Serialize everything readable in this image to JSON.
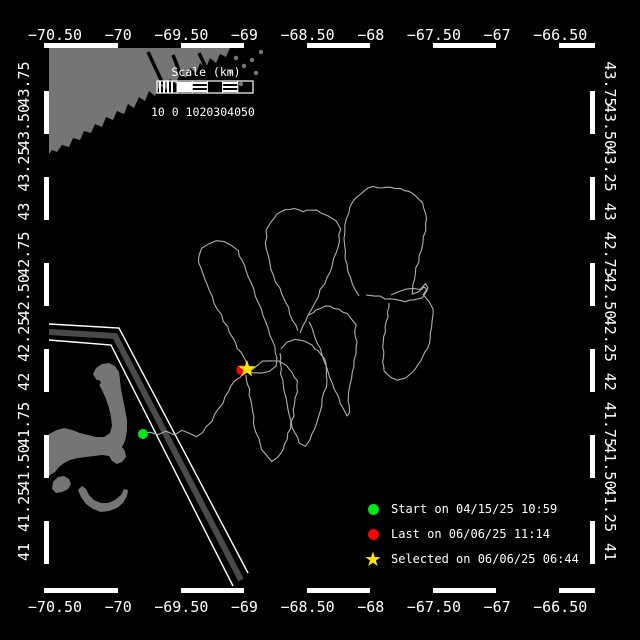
{
  "figure": {
    "width": 640,
    "height": 640
  },
  "colors": {
    "background": "#000000",
    "frame": "#ffffff",
    "zebra": "#000000",
    "land": "#757575",
    "water": "#000000",
    "track": "#b0b0b0",
    "lane_band": "#4a4a4a",
    "lane_edge": "#ffffff",
    "text": "#ffffff",
    "start_marker": "#00e818",
    "last_marker": "#ff0000",
    "selected_marker": "#ffe600"
  },
  "axis": {
    "lon_ticks": [
      {
        "text": "−70.50",
        "lon": -70.5
      },
      {
        "text": "−70",
        "lon": -70
      },
      {
        "text": "−69.50",
        "lon": -69.5
      },
      {
        "text": "−69",
        "lon": -69
      },
      {
        "text": "−68.50",
        "lon": -68.5
      },
      {
        "text": "−68",
        "lon": -68
      },
      {
        "text": "−67.50",
        "lon": -67.5
      },
      {
        "text": "−67",
        "lon": -67
      },
      {
        "text": "−66.50",
        "lon": -66.5
      }
    ],
    "lat_ticks": [
      {
        "text": "43.75",
        "lat": 43.75
      },
      {
        "text": "43.50",
        "lat": 43.5
      },
      {
        "text": "43.25",
        "lat": 43.25
      },
      {
        "text": "43",
        "lat": 43
      },
      {
        "text": "42.75",
        "lat": 42.75
      },
      {
        "text": "42.50",
        "lat": 42.5
      },
      {
        "text": "42.25",
        "lat": 42.25
      },
      {
        "text": "42",
        "lat": 42
      },
      {
        "text": "41.75",
        "lat": 41.75
      },
      {
        "text": "41.50",
        "lat": 41.5
      },
      {
        "text": "41.25",
        "lat": 41.25
      },
      {
        "text": "41",
        "lat": 41
      }
    ]
  },
  "scale_bar": {
    "title": "Scale (km)",
    "tick_labels": "10 0 1020304050",
    "km_values": [
      10,
      0,
      10,
      20,
      30,
      40,
      50
    ],
    "segment_styles": [
      "hatch",
      "solid",
      "striped",
      "dark",
      "striped",
      "dark"
    ]
  },
  "legend": {
    "items": [
      {
        "marker": "circle",
        "color": "#00e818",
        "label": "Start on 04/15/25 10:59"
      },
      {
        "marker": "circle",
        "color": "#ff0000",
        "label": "Last on 06/06/25 11:14"
      },
      {
        "marker": "star",
        "glyph": "★",
        "color": "#ffe600",
        "label": "Selected on 06/06/25 06:44"
      }
    ]
  },
  "markers": {
    "start": {
      "x": 143,
      "y": 434
    },
    "last": {
      "x": 241,
      "y": 370
    },
    "selected": {
      "x": 247,
      "y": 369
    }
  },
  "land": {
    "ne_coast": [
      [
        49,
        48
      ],
      [
        230,
        48
      ],
      [
        226,
        57
      ],
      [
        220,
        54
      ],
      [
        216,
        63
      ],
      [
        210,
        58
      ],
      [
        206,
        68
      ],
      [
        200,
        63
      ],
      [
        196,
        73
      ],
      [
        190,
        68
      ],
      [
        186,
        78
      ],
      [
        180,
        73
      ],
      [
        176,
        84
      ],
      [
        170,
        79
      ],
      [
        166,
        90
      ],
      [
        160,
        85
      ],
      [
        155,
        96
      ],
      [
        149,
        91
      ],
      [
        145,
        101
      ],
      [
        139,
        97
      ],
      [
        134,
        108
      ],
      [
        128,
        104
      ],
      [
        124,
        114
      ],
      [
        117,
        111
      ],
      [
        113,
        120
      ],
      [
        106,
        117
      ],
      [
        102,
        127
      ],
      [
        95,
        124
      ],
      [
        91,
        133
      ],
      [
        84,
        131
      ],
      [
        80,
        140
      ],
      [
        73,
        138
      ],
      [
        69,
        147
      ],
      [
        62,
        145
      ],
      [
        57,
        152
      ],
      [
        52,
        150
      ],
      [
        49,
        154
      ]
    ],
    "inlets": [
      [
        [
          148,
          52
        ],
        [
          163,
          84
        ]
      ],
      [
        [
          173,
          55
        ],
        [
          187,
          91
        ]
      ],
      [
        [
          199,
          53
        ],
        [
          209,
          74
        ]
      ]
    ],
    "islets": [
      [
        236,
        58
      ],
      [
        244,
        66
      ],
      [
        252,
        60
      ],
      [
        256,
        73
      ],
      [
        241,
        84
      ],
      [
        261,
        52
      ],
      [
        231,
        72
      ]
    ],
    "cape_cod": [
      [
        49,
        434
      ],
      [
        57,
        430
      ],
      [
        64,
        428
      ],
      [
        72,
        430
      ],
      [
        80,
        433
      ],
      [
        88,
        435
      ],
      [
        96,
        437
      ],
      [
        104,
        437
      ],
      [
        110,
        433
      ],
      [
        112,
        426
      ],
      [
        111,
        417
      ],
      [
        109,
        408
      ],
      [
        106,
        399
      ],
      [
        102,
        390
      ],
      [
        97,
        381
      ],
      [
        93,
        374
      ],
      [
        96,
        368
      ],
      [
        102,
        364
      ],
      [
        109,
        363
      ],
      [
        115,
        366
      ],
      [
        119,
        372
      ],
      [
        120,
        380
      ],
      [
        121,
        389
      ],
      [
        123,
        399
      ],
      [
        125,
        409
      ],
      [
        127,
        420
      ],
      [
        127,
        431
      ],
      [
        125,
        441
      ],
      [
        122,
        447
      ],
      [
        125,
        451
      ],
      [
        126,
        457
      ],
      [
        122,
        462
      ],
      [
        117,
        464
      ],
      [
        112,
        461
      ],
      [
        109,
        456
      ],
      [
        102,
        455
      ],
      [
        94,
        456
      ],
      [
        86,
        457
      ],
      [
        78,
        458
      ],
      [
        70,
        460
      ],
      [
        64,
        463
      ],
      [
        59,
        467
      ],
      [
        55,
        472
      ],
      [
        50,
        475
      ],
      [
        49,
        476
      ]
    ],
    "harbor": {
      "cx": 95,
      "cy": 384,
      "rx": 6,
      "ry": 3.5,
      "rot": -25
    },
    "marthas_vineyard": [
      [
        53,
        482
      ],
      [
        58,
        477
      ],
      [
        64,
        476
      ],
      [
        69,
        479
      ],
      [
        71,
        484
      ],
      [
        68,
        489
      ],
      [
        62,
        492
      ],
      [
        56,
        493
      ],
      [
        52,
        489
      ]
    ],
    "nantucket": [
      [
        78,
        490
      ],
      [
        81,
        497
      ],
      [
        86,
        504
      ],
      [
        93,
        509
      ],
      [
        101,
        512
      ],
      [
        109,
        511
      ],
      [
        117,
        508
      ],
      [
        123,
        503
      ],
      [
        127,
        496
      ],
      [
        128,
        490
      ],
      [
        124,
        489
      ],
      [
        121,
        495
      ],
      [
        115,
        500
      ],
      [
        108,
        503
      ],
      [
        101,
        503
      ],
      [
        94,
        500
      ],
      [
        89,
        495
      ],
      [
        86,
        489
      ],
      [
        82,
        486
      ]
    ]
  },
  "lane": {
    "edges": [
      [
        [
          49,
          324
        ],
        [
          119,
          328
        ],
        [
          248,
          573
        ]
      ],
      [
        [
          49,
          340
        ],
        [
          111,
          345
        ],
        [
          233,
          586
        ]
      ]
    ],
    "band": [
      [
        49,
        332
      ],
      [
        115,
        336
      ],
      [
        241,
        580
      ]
    ],
    "band_width": 6,
    "edge_width": 1.4
  },
  "track": {
    "paths": [
      [
        [
          142,
          434
        ],
        [
          150,
          432
        ],
        [
          158,
          435
        ],
        [
          166,
          431
        ],
        [
          174,
          434
        ],
        [
          182,
          430
        ],
        [
          189,
          433
        ],
        [
          196,
          436
        ],
        [
          202,
          432
        ],
        [
          207,
          427
        ],
        [
          211,
          421
        ],
        [
          215,
          415
        ],
        [
          219,
          409
        ],
        [
          222,
          403
        ],
        [
          226,
          397
        ],
        [
          229,
          391
        ],
        [
          232,
          386
        ],
        [
          236,
          381
        ],
        [
          240,
          377
        ],
        [
          243,
          373
        ]
      ],
      [
        [
          247,
          366
        ],
        [
          243,
          357
        ],
        [
          238,
          348
        ],
        [
          233,
          338
        ],
        [
          227,
          327
        ],
        [
          221,
          315
        ],
        [
          215,
          303
        ],
        [
          209,
          291
        ],
        [
          204,
          279
        ],
        [
          200,
          267
        ],
        [
          199,
          257
        ],
        [
          202,
          249
        ],
        [
          208,
          244
        ],
        [
          216,
          241
        ],
        [
          224,
          242
        ],
        [
          232,
          245
        ],
        [
          238,
          251
        ],
        [
          242,
          260
        ],
        [
          246,
          271
        ],
        [
          251,
          283
        ],
        [
          256,
          296
        ],
        [
          261,
          309
        ],
        [
          266,
          322
        ],
        [
          270,
          335
        ],
        [
          274,
          347
        ],
        [
          277,
          358
        ],
        [
          276,
          366
        ],
        [
          269,
          371
        ],
        [
          261,
          373
        ],
        [
          253,
          372
        ],
        [
          247,
          369
        ]
      ],
      [
        [
          298,
          331
        ],
        [
          293,
          320
        ],
        [
          288,
          308
        ],
        [
          282,
          295
        ],
        [
          276,
          282
        ],
        [
          271,
          269
        ],
        [
          268,
          256
        ],
        [
          266,
          243
        ],
        [
          267,
          231
        ],
        [
          271,
          221
        ],
        [
          277,
          214
        ],
        [
          285,
          210
        ],
        [
          294,
          209
        ],
        [
          303,
          211
        ],
        [
          312,
          210
        ],
        [
          321,
          212
        ],
        [
          329,
          216
        ],
        [
          336,
          221
        ],
        [
          340,
          229
        ],
        [
          339,
          241
        ],
        [
          336,
          253
        ],
        [
          332,
          265
        ],
        [
          327,
          277
        ],
        [
          321,
          290
        ],
        [
          315,
          303
        ],
        [
          309,
          315
        ],
        [
          304,
          326
        ],
        [
          300,
          333
        ]
      ],
      [
        [
          359,
          296
        ],
        [
          353,
          284
        ],
        [
          348,
          271
        ],
        [
          345,
          258
        ],
        [
          344,
          245
        ],
        [
          344,
          232
        ],
        [
          346,
          219
        ],
        [
          350,
          207
        ],
        [
          356,
          197
        ],
        [
          364,
          190
        ],
        [
          373,
          187
        ],
        [
          382,
          189
        ],
        [
          391,
          187
        ],
        [
          400,
          189
        ],
        [
          409,
          192
        ],
        [
          417,
          197
        ],
        [
          423,
          203
        ],
        [
          426,
          212
        ],
        [
          426,
          224
        ],
        [
          424,
          237
        ],
        [
          421,
          250
        ],
        [
          418,
          262
        ],
        [
          415,
          274
        ],
        [
          413,
          285
        ],
        [
          412,
          294
        ],
        [
          418,
          291
        ],
        [
          424,
          287
        ],
        [
          428,
          291
        ],
        [
          422,
          297
        ],
        [
          414,
          300
        ],
        [
          405,
          301
        ],
        [
          395,
          300
        ],
        [
          385,
          298
        ],
        [
          375,
          296
        ],
        [
          366,
          295
        ]
      ],
      [
        [
          246,
          375
        ],
        [
          248,
          384
        ],
        [
          250,
          395
        ],
        [
          251,
          406
        ],
        [
          253,
          417
        ],
        [
          255,
          428
        ],
        [
          258,
          439
        ],
        [
          262,
          449
        ],
        [
          267,
          457
        ],
        [
          272,
          462
        ],
        [
          278,
          458
        ],
        [
          283,
          449
        ],
        [
          287,
          439
        ],
        [
          290,
          428
        ],
        [
          293,
          416
        ],
        [
          295,
          404
        ],
        [
          297,
          392
        ],
        [
          297,
          381
        ],
        [
          293,
          372
        ],
        [
          287,
          365
        ],
        [
          279,
          361
        ],
        [
          271,
          360
        ],
        [
          263,
          362
        ],
        [
          256,
          366
        ],
        [
          250,
          371
        ]
      ],
      [
        [
          281,
          349
        ],
        [
          287,
          343
        ],
        [
          295,
          340
        ],
        [
          304,
          341
        ],
        [
          312,
          345
        ],
        [
          319,
          351
        ],
        [
          324,
          359
        ],
        [
          327,
          369
        ],
        [
          327,
          381
        ],
        [
          324,
          393
        ],
        [
          321,
          405
        ],
        [
          318,
          417
        ],
        [
          314,
          429
        ],
        [
          310,
          440
        ],
        [
          305,
          447
        ],
        [
          299,
          443
        ],
        [
          295,
          433
        ],
        [
          291,
          422
        ],
        [
          288,
          410
        ],
        [
          285,
          398
        ],
        [
          283,
          386
        ],
        [
          281,
          374
        ],
        [
          280,
          362
        ],
        [
          280,
          353
        ]
      ],
      [
        [
          309,
          315
        ],
        [
          316,
          309
        ],
        [
          325,
          306
        ],
        [
          334,
          308
        ],
        [
          343,
          312
        ],
        [
          351,
          317
        ],
        [
          355,
          325
        ],
        [
          356,
          336
        ],
        [
          356,
          348
        ],
        [
          354,
          360
        ],
        [
          352,
          372
        ],
        [
          350,
          384
        ],
        [
          349,
          396
        ],
        [
          349,
          406
        ],
        [
          350,
          413
        ],
        [
          347,
          416
        ],
        [
          343,
          408
        ],
        [
          339,
          399
        ],
        [
          335,
          389
        ],
        [
          331,
          378
        ],
        [
          327,
          367
        ],
        [
          322,
          355
        ],
        [
          317,
          343
        ],
        [
          312,
          331
        ],
        [
          309,
          322
        ]
      ],
      [
        [
          391,
          295
        ],
        [
          398,
          291
        ],
        [
          406,
          289
        ],
        [
          414,
          288
        ],
        [
          421,
          290
        ],
        [
          425,
          284
        ],
        [
          428,
          288
        ],
        [
          424,
          294
        ],
        [
          429,
          301
        ],
        [
          432,
          309
        ],
        [
          433,
          318
        ],
        [
          432,
          328
        ],
        [
          430,
          338
        ],
        [
          427,
          348
        ],
        [
          423,
          357
        ],
        [
          418,
          365
        ],
        [
          412,
          372
        ],
        [
          405,
          377
        ],
        [
          397,
          381
        ],
        [
          390,
          378
        ],
        [
          385,
          371
        ],
        [
          383,
          362
        ],
        [
          383,
          352
        ],
        [
          384,
          342
        ],
        [
          385,
          332
        ],
        [
          386,
          322
        ],
        [
          388,
          312
        ],
        [
          389,
          303
        ]
      ]
    ]
  }
}
